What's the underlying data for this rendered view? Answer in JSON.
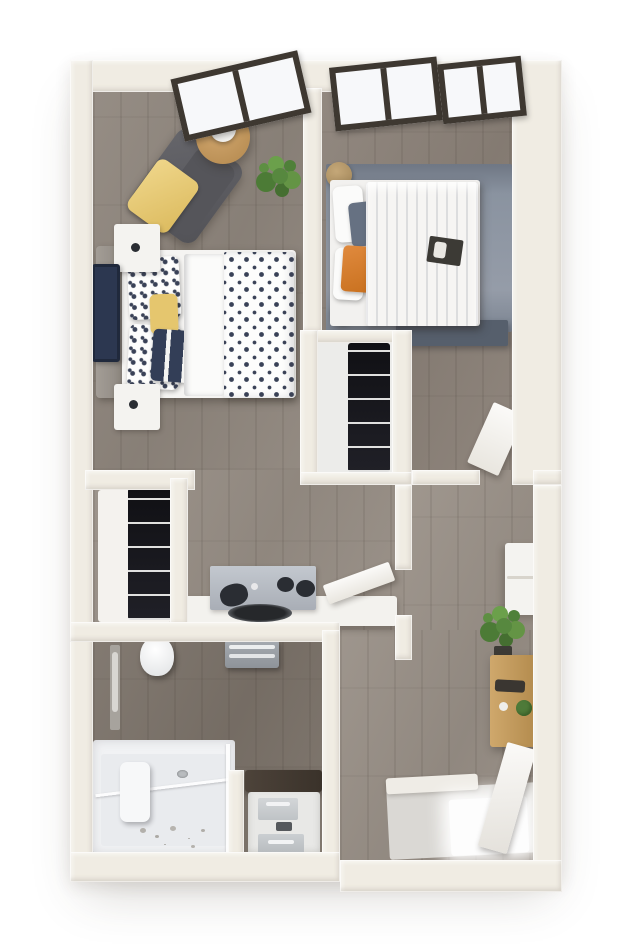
{
  "scene": {
    "title": "3D apartment floor plan render, top-down view",
    "type": "3d-floor-plan"
  },
  "palette": {
    "background": "#ffffff",
    "wall_cream": "#f0ece3",
    "wood_floor": "#948b82",
    "bathroom_floor": "#7e756c",
    "rug_blue_gray": "#8c95a2",
    "duvet_white": "#f6f5f3",
    "polka_dot_navy": "#3a4257",
    "accent_yellow": "#e5c66e",
    "accent_orange": "#d8813a",
    "closet_shelf_dark": "#17171b",
    "appliance_gray": "#b6bbc2",
    "counter_white": "#f3f2ee",
    "vanity_top_brown": "#473e35",
    "desk_wood_tan": "#c49e62",
    "plant_green": "#57883f",
    "decor_tan": "#c3a478",
    "mirror_dark": "#5a534c",
    "window_frame_dark": "#3e3831"
  },
  "rooms": [
    {
      "id": "bedroom-1",
      "position": "top-left",
      "furniture": [
        "angled-window",
        "chaise-lounge-dark-gray",
        "yellow-throw-blanket",
        "round-wood-side-table",
        "white-vase",
        "potted-plant",
        "bed-polka-dot-duvet",
        "polka-dot-pillows",
        "yellow-accent-pillow",
        "navy-throw",
        "gray-headboard",
        "nightstand-north",
        "nightstand-south",
        "navy-wall-art"
      ]
    },
    {
      "id": "bedroom-2",
      "position": "top-right",
      "furniture": [
        "angled-window-left",
        "angled-window-right",
        "blue-gray-area-rug",
        "bed-white-striped-duvet",
        "white-pillows",
        "blue-gray-pillow",
        "orange-throw",
        "breakfast-tray",
        "woven-basket-north",
        "woven-basket-south",
        "bench-dark"
      ]
    },
    {
      "id": "walk-in-closet",
      "position": "center",
      "furniture": [
        "dark-shelving-unit"
      ]
    },
    {
      "id": "kitchen",
      "position": "middle-left",
      "furniture": [
        "pantry-closet-dark-shelves",
        "white-counter",
        "range-with-knobs",
        "inset-sink-dark-oval",
        "open-door-leaf"
      ]
    },
    {
      "id": "bathroom",
      "position": "bottom-left",
      "furniture": [
        "toilet",
        "wall-towel-bar",
        "towel-shelf-gray",
        "walk-in-shower-white",
        "glass-panel",
        "shower-caddy",
        "shower-drain",
        "toiletries",
        "vanity-dark-top",
        "vanity-cabinet-drawers"
      ]
    },
    {
      "id": "entry-hall",
      "position": "right",
      "furniture": [
        "bedroom-door-leaf",
        "tan-wall-hanging",
        "dark-oval-mirror",
        "white-console-shelf",
        "tall-potted-plant",
        "wood-desk",
        "desk-plant",
        "entry-tile",
        "white-door-mat",
        "entry-door-leaf"
      ]
    }
  ]
}
